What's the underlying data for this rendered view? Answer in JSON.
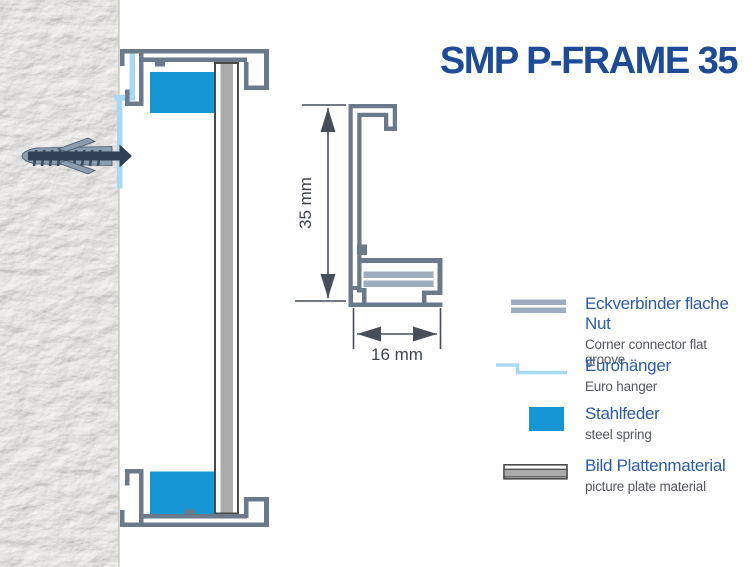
{
  "title": "SMP P-FRAME 35",
  "dimensions": {
    "height_label": "35 mm",
    "width_label": "16 mm"
  },
  "legend": {
    "items": [
      {
        "label_de": "Eckverbinder flache Nut",
        "label_en": "Corner connector flat groove",
        "swatch": "double-bar"
      },
      {
        "label_de": "Eurohänger",
        "label_en": "Euro hanger",
        "swatch": "step-line"
      },
      {
        "label_de": "Stahlfeder",
        "label_en": "steel spring",
        "swatch": "blue-rect"
      },
      {
        "label_de": "Bild Plattenmaterial",
        "label_en": "picture plate material",
        "swatch": "plate-sandwich"
      }
    ]
  },
  "colors": {
    "title_blue": "#1d4b98",
    "label_blue": "#2b5ca8",
    "sublabel_gray": "#54585e",
    "profile_outline": "#6b7a8b",
    "steel_spring_blue": "#1697d3",
    "euro_hanger_blue": "#a7d9f3",
    "connector_gray": "#9dadbd",
    "plate_gray": "#ababab",
    "dimension_gray": "#474e58"
  }
}
